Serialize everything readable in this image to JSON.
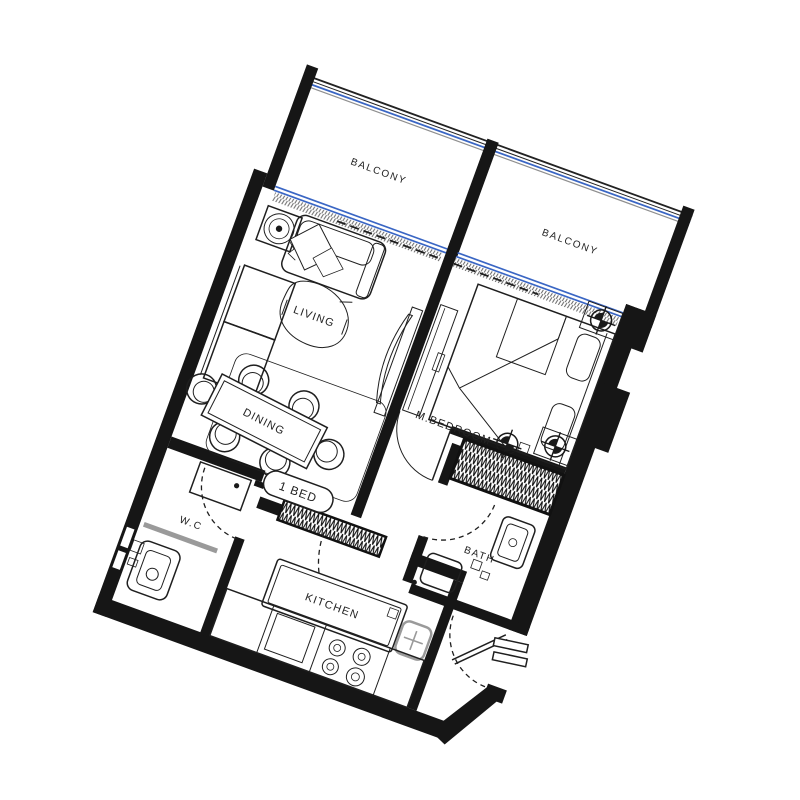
{
  "floor_plan": {
    "unit_type_badge": "1 BED",
    "rooms": {
      "balcony_left": "BALCONY",
      "balcony_right": "BALCONY",
      "living": "LIVING",
      "dining": "DINING",
      "master_bedroom": "M.BEDROOM",
      "bath": "BATH",
      "wc": "W.C",
      "kitchen": "KITCHEN"
    },
    "colors": {
      "wall": "#161616",
      "line": "#1f1f1f",
      "window_glass": "#3a66c4",
      "railing_gray": "#8f8f8f",
      "counter_gray": "#9a9a9a",
      "background": "#ffffff"
    },
    "orientation_degrees": 20
  }
}
